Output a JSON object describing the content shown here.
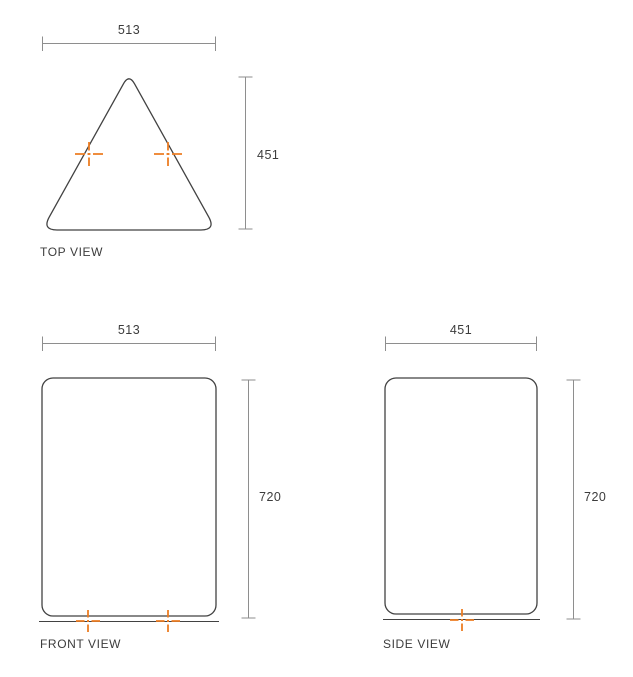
{
  "drawing": {
    "views": {
      "top": {
        "label": "TOP VIEW",
        "width": "513",
        "depth": "451"
      },
      "front": {
        "label": "FRONT VIEW",
        "width": "513",
        "height": "720"
      },
      "side": {
        "label": "SIDE VIEW",
        "depth": "451",
        "height": "720"
      }
    }
  },
  "colors": {
    "outline": "#424242",
    "dimension": "#8e8e8e",
    "text": "#3c3c3c",
    "accent": "#ed7d23",
    "background": "#ffffff"
  }
}
